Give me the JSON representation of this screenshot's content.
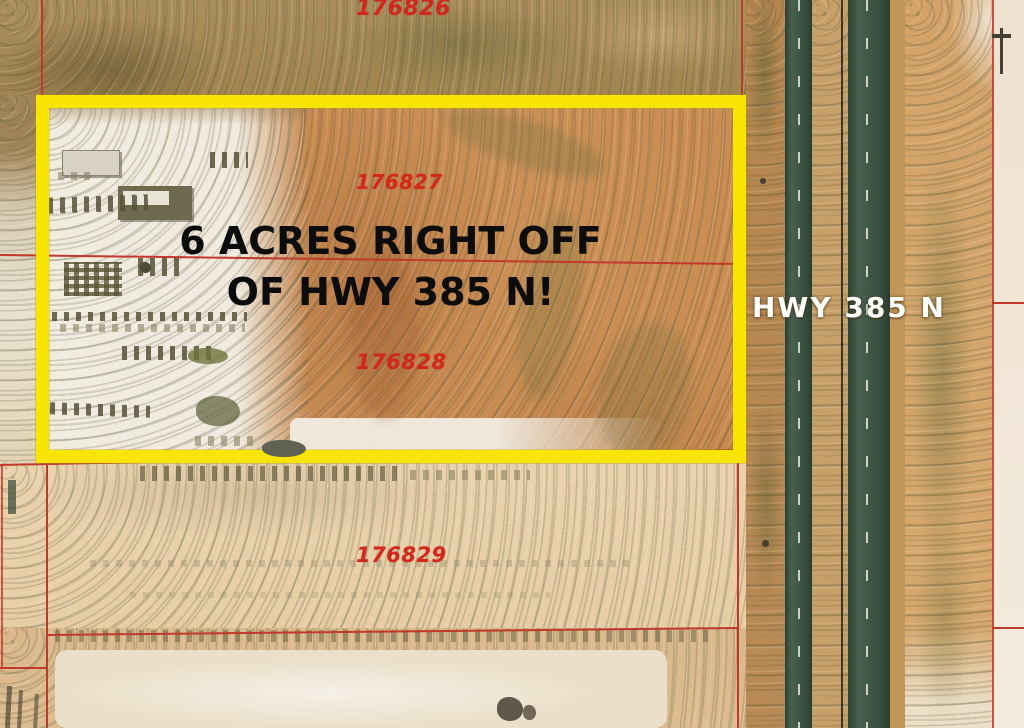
{
  "map": {
    "promo": {
      "line1": "6 ACRES RIGHT OFF",
      "line2": "OF HWY 385 N!"
    },
    "highway_label": "HWY 385 N",
    "parcels": [
      {
        "id": "176826"
      },
      {
        "id": "176827"
      },
      {
        "id": "176828"
      },
      {
        "id": "176829"
      }
    ],
    "colors": {
      "highlight_box": "#f8e504",
      "parcel_line": "#c0392b",
      "parcel_label": "#d2271b",
      "promo_text": "#0c0c0c",
      "highway_label_text": "#ffffff",
      "road_surface": "#3d5745",
      "field": "#cd9258",
      "yard_white": "#f1ece1"
    }
  }
}
